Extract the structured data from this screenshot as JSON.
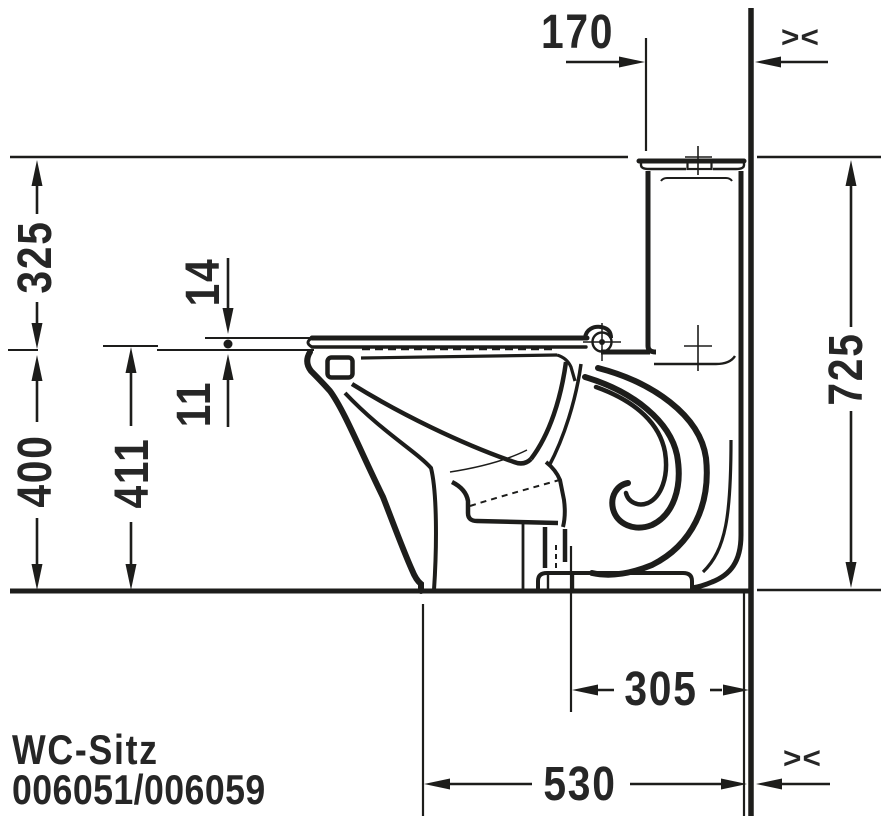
{
  "drawing": {
    "product_label": "WC-Sitz",
    "product_codes": "006051/006059",
    "dimensions": {
      "tank_front_to_wall": "170",
      "seat_level_to_top": "325",
      "rim_height": "400",
      "seat_height": "411",
      "seat_gap_upper": "14",
      "seat_gap_lower": "11",
      "total_height": "725",
      "outlet_to_wall": "305",
      "foot_to_wall": "530"
    },
    "symbols": {
      "variable_gap_top": "><",
      "variable_gap_bottom": "><"
    },
    "colors": {
      "line": "#1d1d1b",
      "text": "#262626",
      "background": "#ffffff"
    }
  }
}
